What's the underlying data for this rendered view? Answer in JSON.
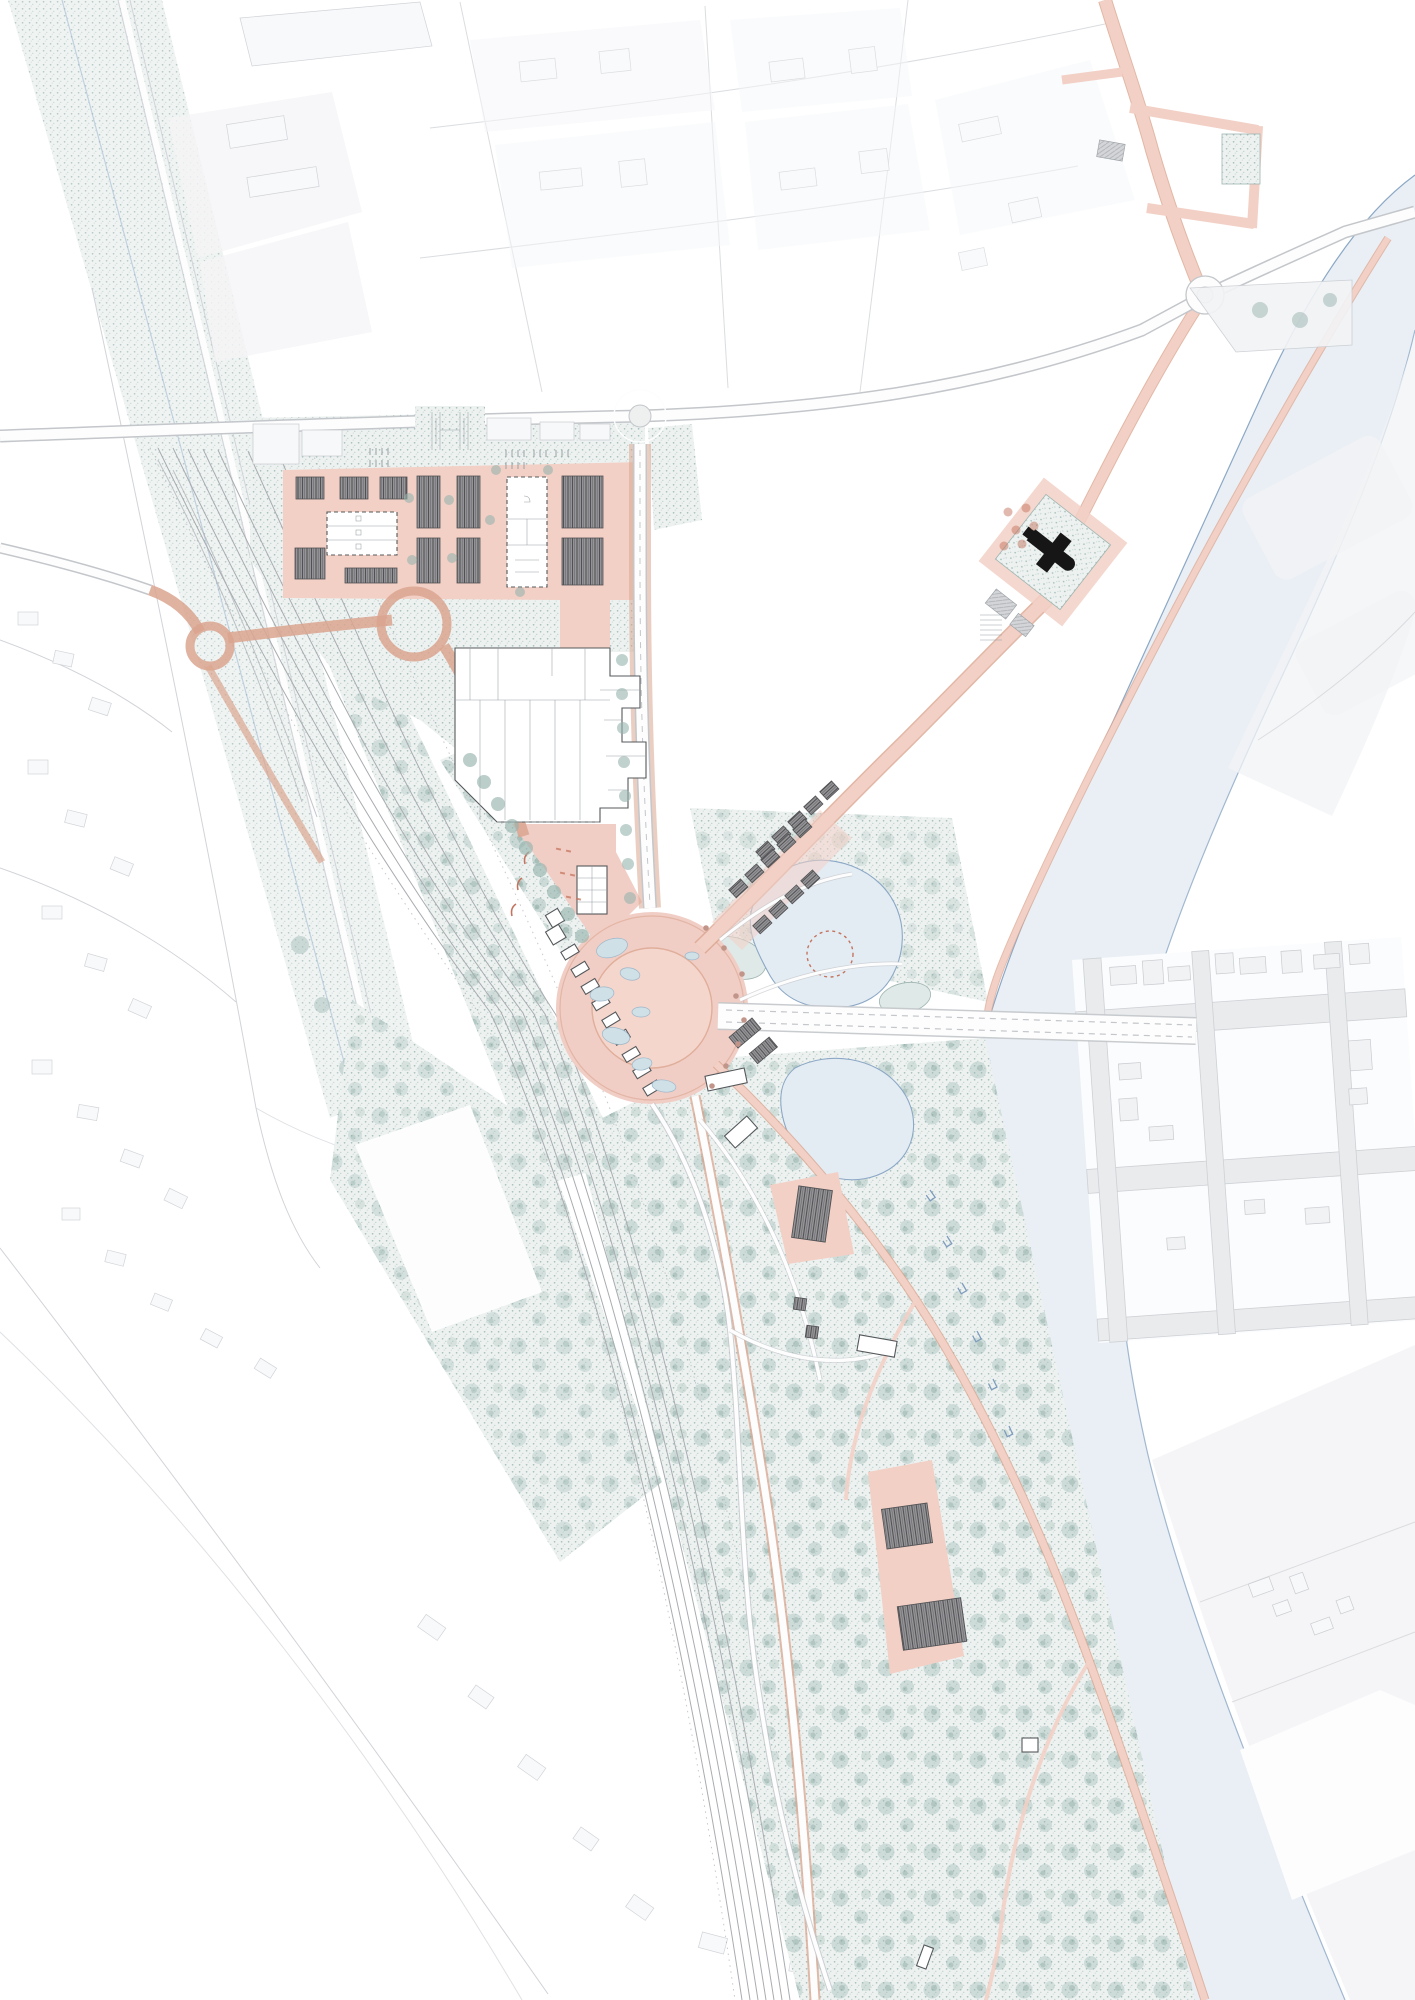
{
  "canvas": {
    "width": 1415,
    "height": 2000
  },
  "palette": {
    "background": "#ffffff",
    "context_fill": "#f2f3f5",
    "context_line": "#c9ccd1",
    "faint_building": "#f7f8f9",
    "road_fill": "#fdfdfd",
    "road_casing": "#c3c6ca",
    "street_pink": "#f2d0c6",
    "street_pink_edge": "#dba58f",
    "plaza_pink": "#f1cec5",
    "dark_block_line": "#515154",
    "building_fill": "#ffffff",
    "building_line": "#55585b",
    "veg_base": "#edf2f1",
    "veg_dot": "#a4bdb8",
    "tree": "#97b4ae",
    "river_fill": "#e9eff5",
    "river_edge": "#8ca8c6",
    "lake_fill": "#e4ecf3",
    "rail_line": "#a9acb0",
    "accent_red": "#c4745e",
    "church_black": "#161616"
  }
}
